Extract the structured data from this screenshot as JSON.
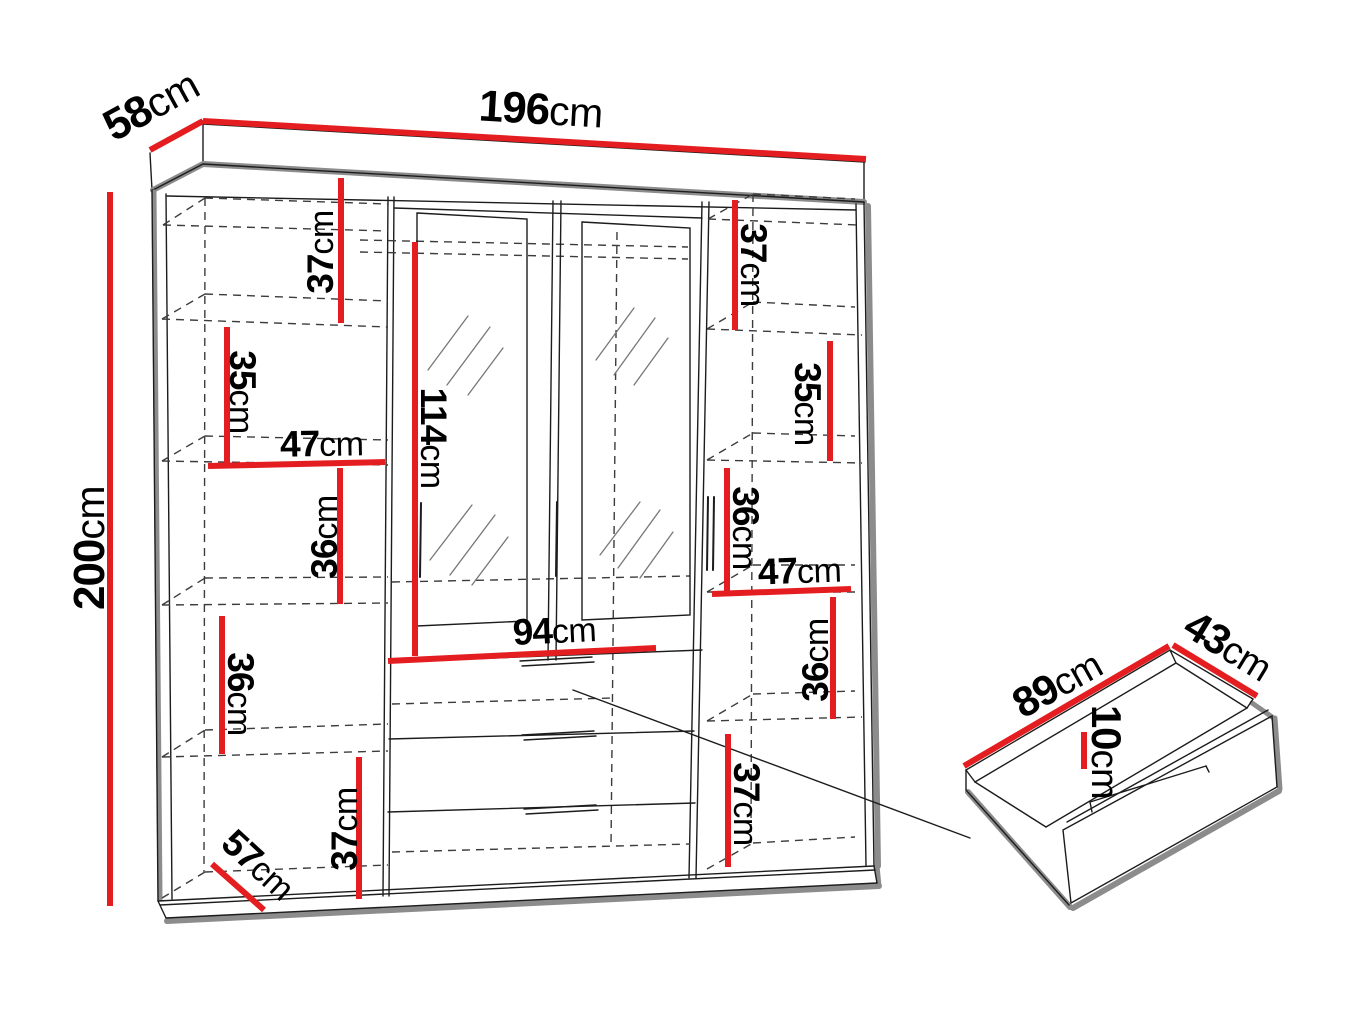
{
  "diagram": {
    "kind": "wardrobe-dimension-diagram",
    "unit": "cm"
  },
  "colors": {
    "red": "#e41e20",
    "outline": "#1c1c1c",
    "shadow": "#8c8c8c",
    "hidden": "#3c3c3c",
    "hatch": "#777777",
    "bg": "#ffffff"
  },
  "labels": [
    {
      "id": "width-top",
      "num": "196",
      "unit": "cm"
    },
    {
      "id": "depth-top",
      "num": "58",
      "unit": "cm"
    },
    {
      "id": "height-left",
      "num": "200",
      "unit": "cm"
    },
    {
      "id": "left-gap-1",
      "num": "37",
      "unit": "cm"
    },
    {
      "id": "left-gap-2",
      "num": "35",
      "unit": "cm"
    },
    {
      "id": "left-shelf-width",
      "num": "47",
      "unit": "cm"
    },
    {
      "id": "left-gap-3",
      "num": "36",
      "unit": "cm"
    },
    {
      "id": "left-gap-4",
      "num": "36",
      "unit": "cm"
    },
    {
      "id": "left-gap-5",
      "num": "37",
      "unit": "cm"
    },
    {
      "id": "left-bottom-depth",
      "num": "57",
      "unit": "cm"
    },
    {
      "id": "mirror-height",
      "num": "114",
      "unit": "cm"
    },
    {
      "id": "center-width",
      "num": "94",
      "unit": "cm"
    },
    {
      "id": "right-gap-1",
      "num": "37",
      "unit": "cm"
    },
    {
      "id": "right-gap-2",
      "num": "35",
      "unit": "cm"
    },
    {
      "id": "right-gap-3",
      "num": "36",
      "unit": "cm"
    },
    {
      "id": "right-shelf-width",
      "num": "47",
      "unit": "cm"
    },
    {
      "id": "right-gap-4",
      "num": "36",
      "unit": "cm"
    },
    {
      "id": "right-gap-5",
      "num": "37",
      "unit": "cm"
    },
    {
      "id": "drawer-width",
      "num": "89",
      "unit": "cm"
    },
    {
      "id": "drawer-depth",
      "num": "43",
      "unit": "cm"
    },
    {
      "id": "drawer-height",
      "num": "10",
      "unit": "cm"
    }
  ]
}
